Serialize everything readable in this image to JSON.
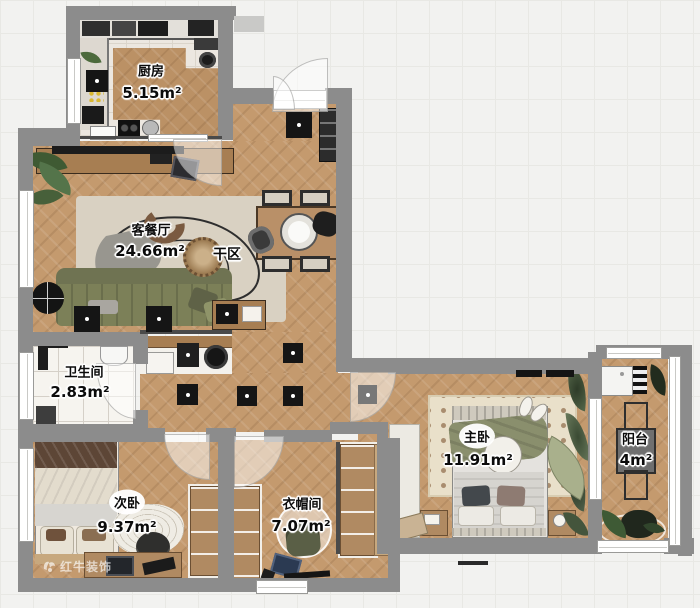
{
  "floorplan": {
    "rooms": {
      "kitchen": {
        "name": "厨房",
        "area": "5.15m²"
      },
      "living_dining": {
        "name": "客餐厅",
        "area": "24.66m²"
      },
      "bathroom": {
        "name": "卫生间",
        "area": "2.83m²"
      },
      "second_bedroom": {
        "name": "次卧",
        "area": "9.37m²"
      },
      "cloakroom": {
        "name": "衣帽间",
        "area": "7.07m²"
      },
      "master_bedroom": {
        "name": "主卧",
        "area": "11.91m²"
      },
      "balcony": {
        "name": "阳台",
        "area": "4m²"
      }
    },
    "labels": {
      "dry_zone": "干区"
    },
    "watermark": {
      "brand": "红牛装饰"
    },
    "colors": {
      "wall": "#8c8c8c",
      "wood_floor": "#c49a6e",
      "kitchen_tile": "#ece7e0",
      "bath_tile": "#f6f4ef",
      "sofa_green": "#7c8058",
      "rug_beige": "#d9d1c2",
      "label_text": "#0b0b0b"
    }
  }
}
